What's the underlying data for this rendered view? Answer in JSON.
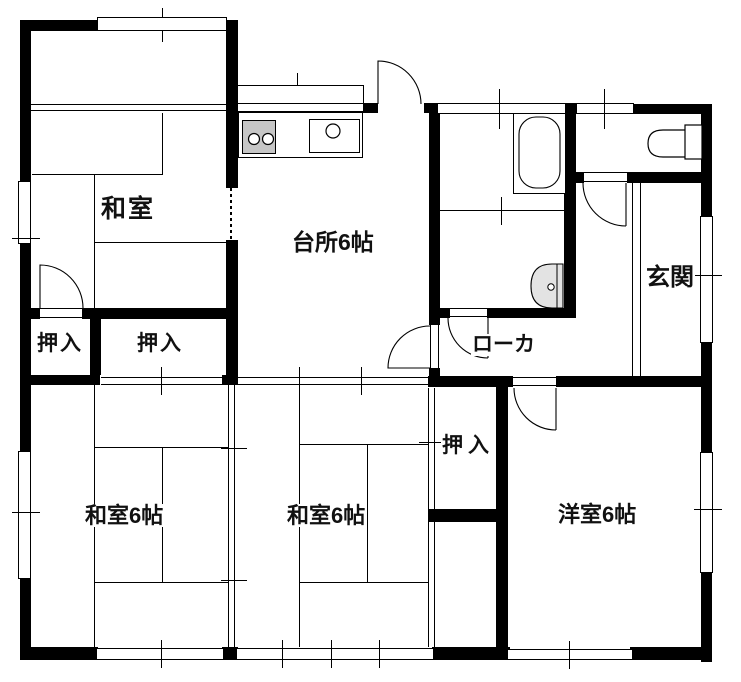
{
  "plan_title": "1F floor plan",
  "rooms": {
    "washitsu_top": {
      "label": "和室",
      "type": "japanese-room"
    },
    "kitchen": {
      "label": "台所6帖",
      "type": "kitchen",
      "size_jo": 6
    },
    "oshiire_left": {
      "label": "押入",
      "type": "closet"
    },
    "oshiire_center": {
      "label": "押入",
      "type": "closet"
    },
    "oshiire_middle": {
      "label": "押入",
      "type": "closet"
    },
    "washitsu_bottom_left": {
      "label": "和室6帖",
      "type": "japanese-room",
      "size_jo": 6
    },
    "washitsu_bottom_center": {
      "label": "和室6帖",
      "type": "japanese-room",
      "size_jo": 6
    },
    "youshitsu": {
      "label": "洋室6帖",
      "type": "western-room",
      "size_jo": 6
    },
    "genkan": {
      "label": "玄関",
      "type": "entrance"
    },
    "corridor": {
      "label": "ローカ",
      "type": "hallway"
    }
  },
  "fixtures": [
    "gas-stove",
    "kitchen-sink",
    "bathtub",
    "toilet",
    "washbasin",
    "genkan-step"
  ],
  "colors": {
    "wall": "#000000",
    "background": "#ffffff",
    "stove_gray": "#c6c6c6",
    "basin_gray": "#e3e3e3"
  }
}
